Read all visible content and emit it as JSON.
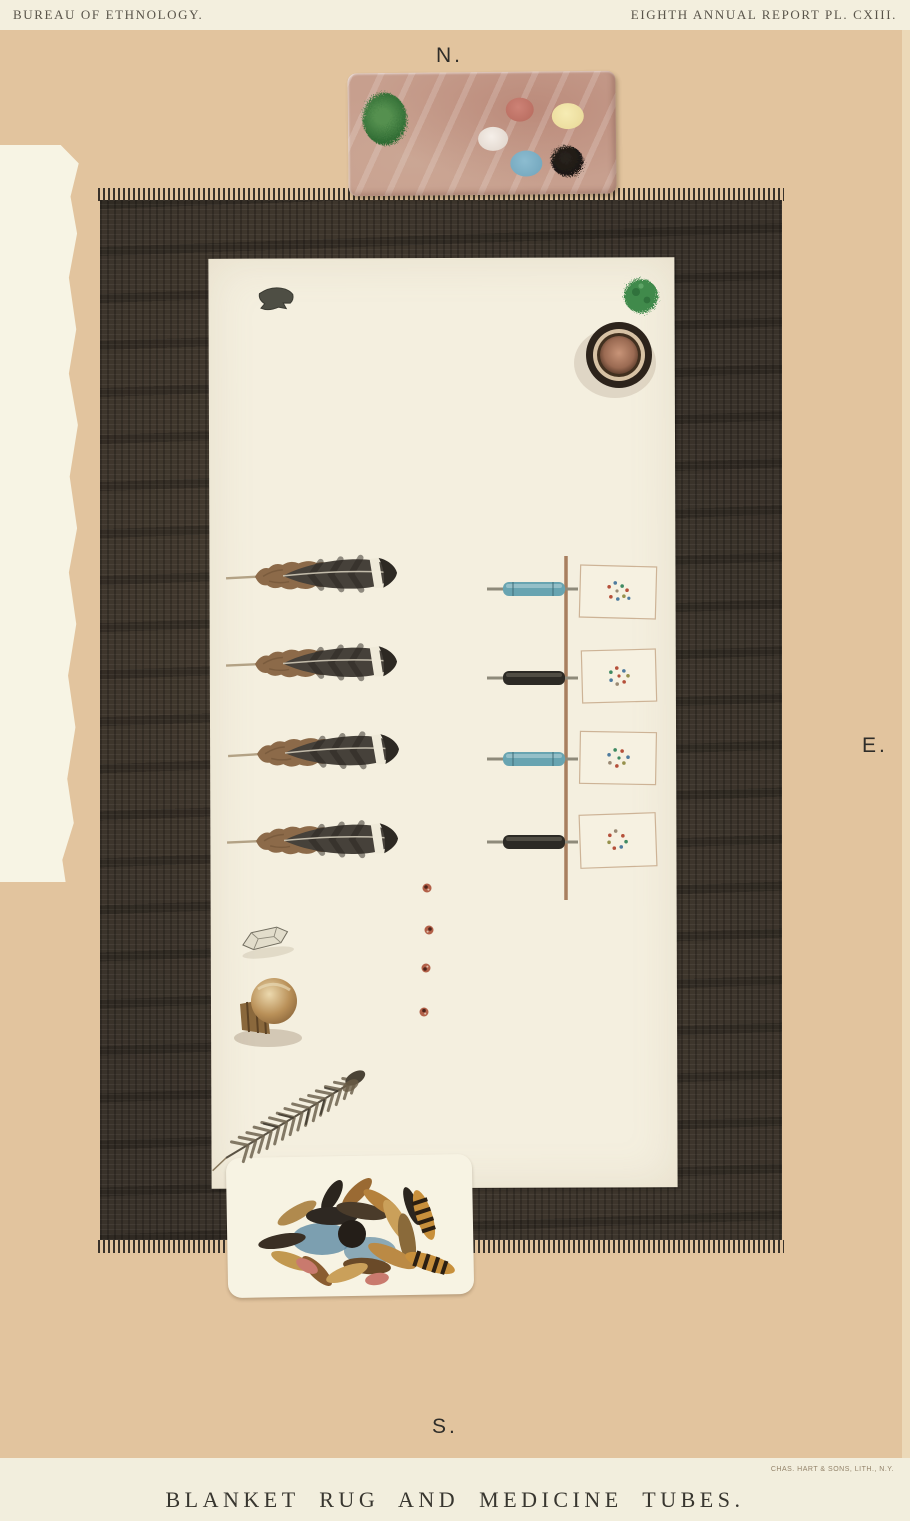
{
  "plate": {
    "header_left": "BUREAU OF ETHNOLOGY.",
    "header_right": "EIGHTH ANNUAL REPORT PL. CXIII.",
    "compass": {
      "north": "N.",
      "east": "E.",
      "south": "S."
    },
    "caption": "BLANKET RUG AND MEDICINE TUBES.",
    "lithographer": "CHAS. HART & SONS, LITH., N.Y."
  },
  "colors": {
    "page_tan": "#e2c49e",
    "header_band": "#f3efde",
    "rug_black": "#39322a",
    "cloth_white": "#f4efdf",
    "palette_stone": "#c79f8e",
    "tube_blue": "#68a4b1",
    "tube_black": "#2c2a25",
    "stick_brown": "#a87f5f",
    "paint_spots": [
      "#2f6b33",
      "#c4766a",
      "#efe8e2",
      "#f2e6a8",
      "#7fb3c9",
      "#1b1713"
    ]
  },
  "objects": {
    "palette": "stone paint palette with six paint spots",
    "rug": "black fringed blanket rug",
    "cloth": "white canvas spread on rug",
    "arrowhead": "flint arrowhead",
    "herb_mass": "green herb medicine mass",
    "bowl": "medicine bowl",
    "feathers": "four eagle tail feathers",
    "medicine_tubes": "four medicine tubes (blue, black, blue, black) lashed to a stick",
    "pollen_papers": "four paper squares with scattered pollen grains",
    "seed_beads": "four small seed beads",
    "crystal": "quartz crystal",
    "rattle": "shell rattle in basket cup",
    "downy_feather": "downy feather",
    "feather_bundle": "bundle of small feathers on paper sheet"
  }
}
